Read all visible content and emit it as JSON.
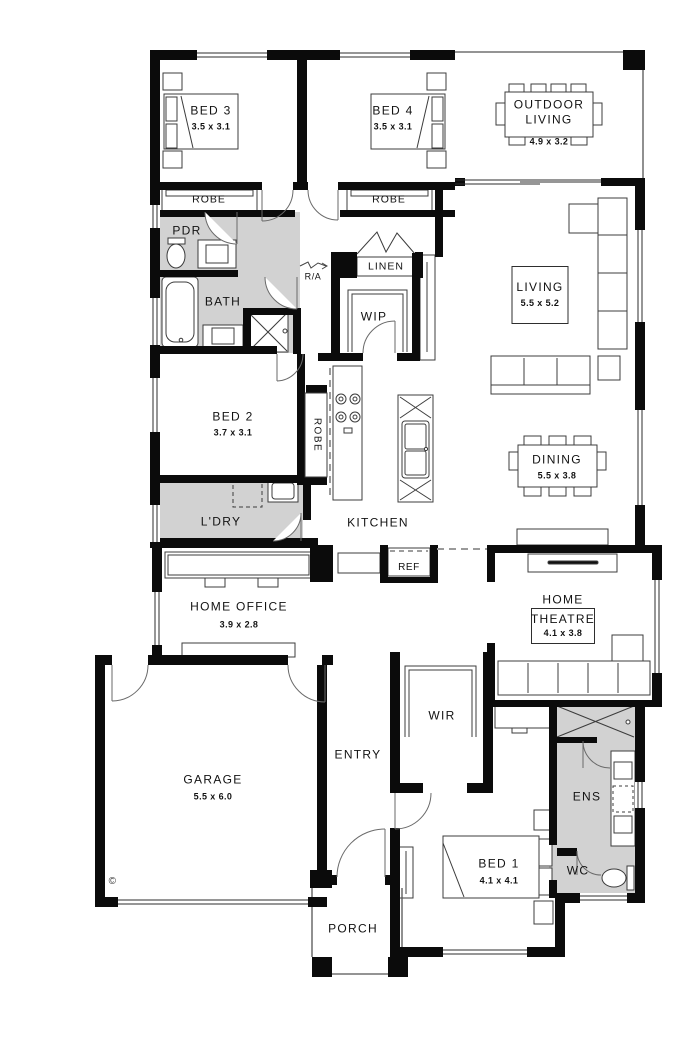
{
  "colors": {
    "wall": "#0b0b0b",
    "wet_area_fill": "#d2d2d2",
    "furniture_line": "#3c3c3c"
  },
  "watermark": "©",
  "rooms": {
    "bed3": {
      "label": "BED 3",
      "dims": "3.5 x 3.1"
    },
    "bed4": {
      "label": "BED 4",
      "dims": "3.5 x 3.1"
    },
    "outdoor_living": {
      "label_line1": "OUTDOOR",
      "label_line2": "LIVING",
      "dims": "4.9 x 3.2"
    },
    "robe_bed3": {
      "label": "ROBE"
    },
    "robe_bed4": {
      "label": "ROBE"
    },
    "robe_bed2": {
      "label": "ROBE"
    },
    "pdr": {
      "label": "PDR"
    },
    "linen": {
      "label": "LINEN"
    },
    "return_air": {
      "label": "R/A"
    },
    "bath": {
      "label": "BATH"
    },
    "wip": {
      "label": "WIP"
    },
    "living": {
      "label": "LIVING",
      "dims": "5.5 x 5.2"
    },
    "bed2": {
      "label": "BED 2",
      "dims": "3.7 x 3.1"
    },
    "dining": {
      "label": "DINING",
      "dims": "5.5 x 3.8"
    },
    "ldry": {
      "label": "L'DRY"
    },
    "kitchen": {
      "label": "KITCHEN"
    },
    "ref": {
      "label": "REF"
    },
    "home_office": {
      "label": "HOME OFFICE",
      "dims": "3.9 x 2.8"
    },
    "home_theatre": {
      "label_line1": "HOME",
      "label_line2": "THEATRE",
      "dims": "4.1 x 3.8"
    },
    "garage": {
      "label": "GARAGE",
      "dims": "5.5 x 6.0"
    },
    "entry": {
      "label": "ENTRY"
    },
    "wir": {
      "label": "WIR"
    },
    "ens": {
      "label": "ENS"
    },
    "bed1": {
      "label": "BED 1",
      "dims": "4.1 x 4.1"
    },
    "wc": {
      "label": "WC"
    },
    "porch": {
      "label": "PORCH"
    }
  }
}
